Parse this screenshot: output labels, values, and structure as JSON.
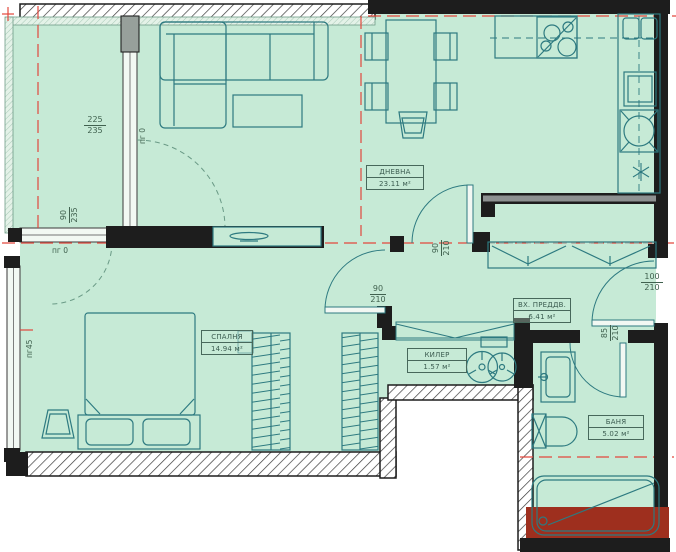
{
  "plan_title": "Apartment floor plan",
  "rooms": {
    "living": {
      "name": "ДНЕВНА",
      "area": "23.11 м²"
    },
    "bedroom": {
      "name": "СПАЛНЯ",
      "area": "14.94 м²"
    },
    "entry": {
      "name": "ВХ. ПРЕДДВ.",
      "area": "6.41 м²"
    },
    "closet": {
      "name": "КИЛЕР",
      "area": "1.57 м²"
    },
    "bath": {
      "name": "БАНЯ",
      "area": "5.02 м²"
    }
  },
  "openings": {
    "balcony_window": {
      "w": "225",
      "h": "235"
    },
    "bedroom_window": {
      "w": "90",
      "h": "235"
    },
    "corridor_door": {
      "w": "90",
      "h": "210"
    },
    "hall_door": {
      "w": "90",
      "h": "210"
    },
    "entry_door": {
      "w": "100",
      "h": "210"
    },
    "bath_door": {
      "w": "85",
      "h": "210"
    },
    "sill_zero_a": "пг 0",
    "sill_zero_b": "пг 0",
    "sill_45": "пг45"
  },
  "colors": {
    "room_fill": "#c6ead6",
    "wall": "#1d1d1d",
    "furniture_line": "#2d7a80",
    "axis_red": "#e2483d",
    "marked_wall_red": "#9e2f1e",
    "wall_core_gray": "#8d9191"
  }
}
